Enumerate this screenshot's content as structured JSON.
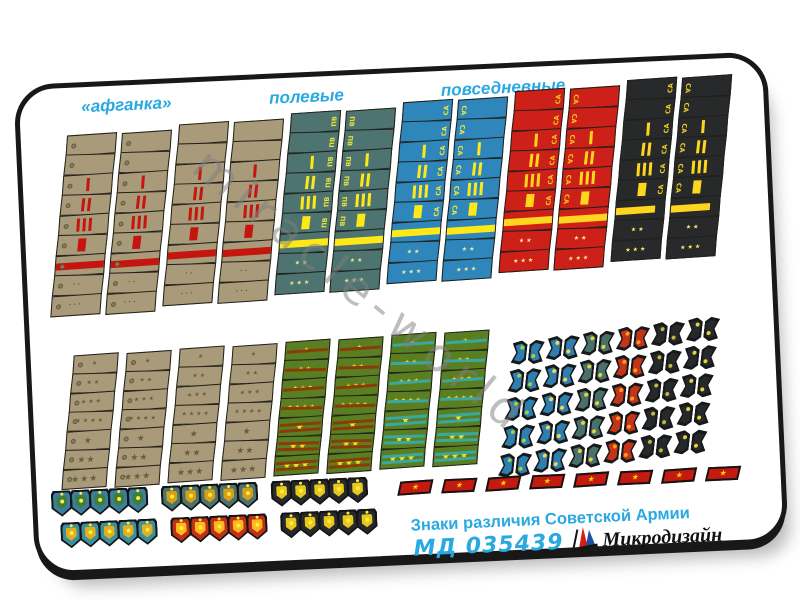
{
  "header": {
    "labels": [
      {
        "text": "«афганка»"
      },
      {
        "text": "полевые"
      },
      {
        "text": "повседневные"
      }
    ],
    "label_color": "#29a9e1"
  },
  "sergeant_groups": [
    {
      "name": "afganka-khaki",
      "letter": "",
      "base": "#a99b79",
      "accent": "#c4160e",
      "star_color": "#5f5640",
      "star_glyph": "dot",
      "buttons": true,
      "band_width": "100%"
    },
    {
      "name": "field-khaki",
      "letter": "",
      "base": "#a99b79",
      "accent": "#c4160e",
      "star_color": "#5f5640",
      "star_glyph": "dot",
      "buttons": false,
      "band_width": "100%"
    },
    {
      "name": "everyday-teal-PV",
      "letter": "ПВ",
      "letter_color": "#e8e23a",
      "base": "#4d7470",
      "accent": "#ffe818",
      "star_color": "#dfe98c",
      "star_glyph": "star",
      "buttons": false,
      "band_width": "100%"
    },
    {
      "name": "everyday-blue-SA",
      "letter": "СА",
      "letter_color": "#f0e63c",
      "base": "#2f86ba",
      "accent": "#ffe818",
      "star_color": "#e8f0a0",
      "star_glyph": "star",
      "buttons": false,
      "band_width": "100%"
    },
    {
      "name": "everyday-red-SA",
      "letter": "СА",
      "letter_color": "#f5c81e",
      "base": "#cc2018",
      "accent": "#ffd61e",
      "star_color": "#ffe894",
      "star_glyph": "star",
      "buttons": false,
      "band_width": "100%"
    },
    {
      "name": "everyday-black-SA",
      "letter": "СА",
      "letter_color": "#f0d21e",
      "base": "#27292b",
      "accent": "#ffd61e",
      "star_color": "#ffe86a",
      "star_glyph": "star",
      "buttons": false,
      "band_width": "82%"
    }
  ],
  "rank_rows": [
    {
      "rank": "plain"
    },
    {
      "rank": "plain"
    },
    {
      "rank": "one-narrow-stripe",
      "stripes": 1
    },
    {
      "rank": "two-narrow-stripes",
      "stripes": 2
    },
    {
      "rank": "three-narrow-stripes",
      "stripes": 3
    },
    {
      "rank": "one-wide-stripe",
      "stripes": 1,
      "wide": true
    },
    {
      "rank": "longitudinal-band",
      "band": true
    },
    {
      "rank": "two-stars",
      "stars": 2
    },
    {
      "rank": "three-stars",
      "stars": 3
    }
  ],
  "officer_groups": [
    {
      "name": "afganka-officer",
      "base": "#a99b79",
      "stripe": "",
      "star_color": "#6a5d3f",
      "texture": false,
      "buttons": true
    },
    {
      "name": "field-officer",
      "base": "#a99b79",
      "stripe": "",
      "star_color": "#6a5d3f",
      "texture": false,
      "buttons": false
    },
    {
      "name": "everyday-green-red-stripe",
      "base": "#5a7f22",
      "stripe": "#8a3c08",
      "star_color": "#ffe020",
      "texture": true,
      "buttons": false
    },
    {
      "name": "everyday-green-teal-stripe",
      "base": "#5a7f22",
      "stripe": "#3aa89e",
      "star_color": "#ffe020",
      "texture": true,
      "buttons": false
    }
  ],
  "officer_rows": [
    {
      "stripes": 1,
      "stars": 1,
      "big": false
    },
    {
      "stripes": 1,
      "stars": 2,
      "big": false
    },
    {
      "stripes": 1,
      "stars": 3,
      "big": false
    },
    {
      "stripes": 1,
      "stars": 4,
      "big": false
    },
    {
      "stripes": 2,
      "stars": 1,
      "big": true
    },
    {
      "stripes": 2,
      "stars": 2,
      "big": true
    },
    {
      "stripes": 2,
      "stars": 3,
      "big": true
    }
  ],
  "collar_chevrons": {
    "rows": 5,
    "columns": [
      {
        "face": "#2e7fb0",
        "emblem": "#9fd23c"
      },
      {
        "face": "#2e7fb0",
        "emblem": "#ffd24a"
      },
      {
        "face": "#49706b",
        "emblem": "#e8d23a"
      },
      {
        "face": "#c33418",
        "emblem": "#ff9a1e"
      },
      {
        "face": "#26292c",
        "emblem": "#c8b63a"
      },
      {
        "face": "#26292c",
        "emblem": "#e8d23a"
      }
    ]
  },
  "collar_tabs": {
    "count": 8,
    "color": "#c41a10",
    "star_color": "#ffd200",
    "star_glyph": "★"
  },
  "sleeve_patches": {
    "rows": [
      {
        "groups": [
          {
            "count": 5,
            "face": "#3a7fa0",
            "emblem": "#3f7d3a"
          },
          {
            "count": 5,
            "face": "#4a7370",
            "emblem": "#d8a018"
          },
          {
            "count": 5,
            "face": "#26292c",
            "emblem": "#e8c81e"
          }
        ]
      },
      {
        "groups": [
          {
            "count": 5,
            "face": "#3a8fa0",
            "emblem": "#e0b020"
          },
          {
            "count": 5,
            "face": "#c03018",
            "emblem": "#ffb81e"
          },
          {
            "count": 5,
            "face": "#26292c",
            "emblem": "#e8c81e"
          }
        ]
      }
    ]
  },
  "footer": {
    "title": "Знаки различия Советской Армии",
    "sku": "МД 035439",
    "brand": "Микродизайн",
    "text_color": "#29a9e1",
    "logo_red": "#d42015",
    "logo_blue": "#1f4f9e"
  },
  "watermark": {
    "text": "miracle-world"
  },
  "glyphs": {
    "star": "★",
    "dot": "•"
  }
}
